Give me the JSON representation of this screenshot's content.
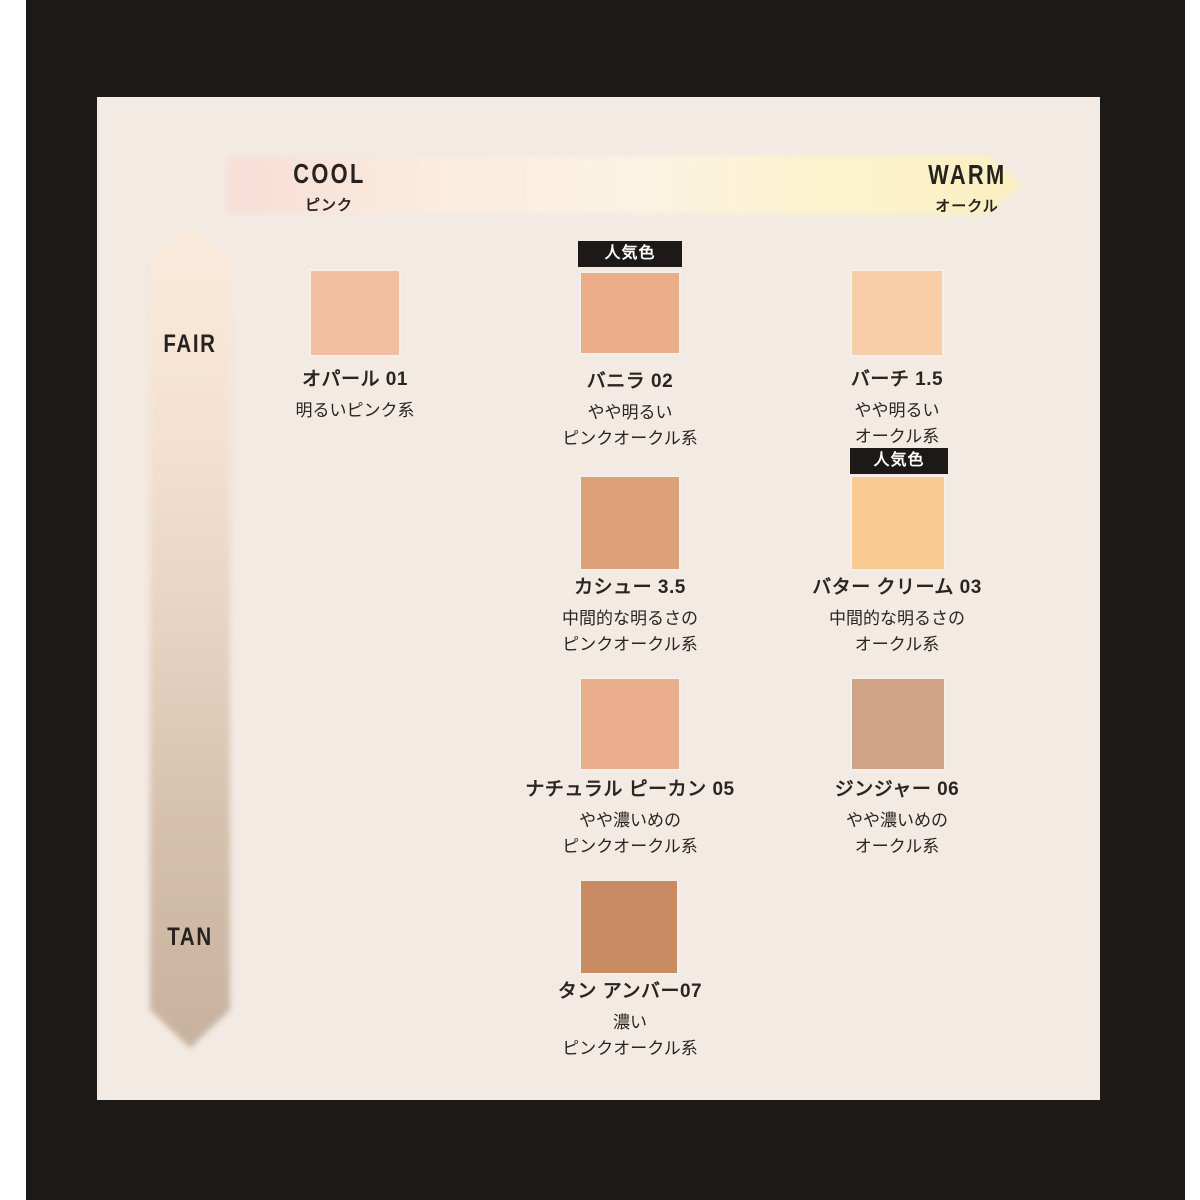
{
  "page": {
    "background": "#ffffff",
    "frame_color": "#1c1a18",
    "panel_color": "#f2eae3",
    "text_color": "#2a2520"
  },
  "temperature_axis": {
    "cool_label": "COOL",
    "cool_sublabel": "ピンク",
    "warm_label": "WARM",
    "warm_sublabel": "オークル",
    "gradient": [
      "#f8ddd5",
      "#faebdd",
      "#fbf2e4",
      "#fcf3ce",
      "#fbefc0"
    ]
  },
  "depth_axis": {
    "top_label": "FAIR",
    "bottom_label": "TAN",
    "gradient": [
      "#fbeadc",
      "#f4e1d0",
      "#e6d2c1",
      "#d4bfab",
      "#c8b29f"
    ]
  },
  "popular_badge_label": "人気色",
  "shades": [
    {
      "name": "オパール 01",
      "desc_line1": "明るいピンク系",
      "desc_line2": "",
      "color": "#f2bfa0",
      "popular": false
    },
    {
      "name": "バニラ 02",
      "desc_line1": "やや明るい",
      "desc_line2": "ピンクオークル系",
      "color": "#ebae89",
      "popular": true
    },
    {
      "name": "バーチ 1.5",
      "desc_line1": "やや明るい",
      "desc_line2": "オークル系",
      "color": "#f8cea9",
      "popular": false
    },
    {
      "name": "カシュー 3.5",
      "desc_line1": "中間的な明るさの",
      "desc_line2": "ピンクオークル系",
      "color": "#dda078",
      "popular": false
    },
    {
      "name": "バター クリーム 03",
      "desc_line1": "中間的な明るさの",
      "desc_line2": "オークル系",
      "color": "#fac994",
      "popular": true
    },
    {
      "name": "ナチュラル ピーカン 05",
      "desc_line1": "やや濃いめの",
      "desc_line2": "ピンクオークル系",
      "color": "#ebae8d",
      "popular": false
    },
    {
      "name": "ジンジャー 06",
      "desc_line1": "やや濃いめの",
      "desc_line2": "オークル系",
      "color": "#cfa384",
      "popular": false
    },
    {
      "name": "タン アンバー07",
      "desc_line1": "濃い",
      "desc_line2": "ピンクオークル系",
      "color": "#c98b64",
      "popular": false
    }
  ]
}
